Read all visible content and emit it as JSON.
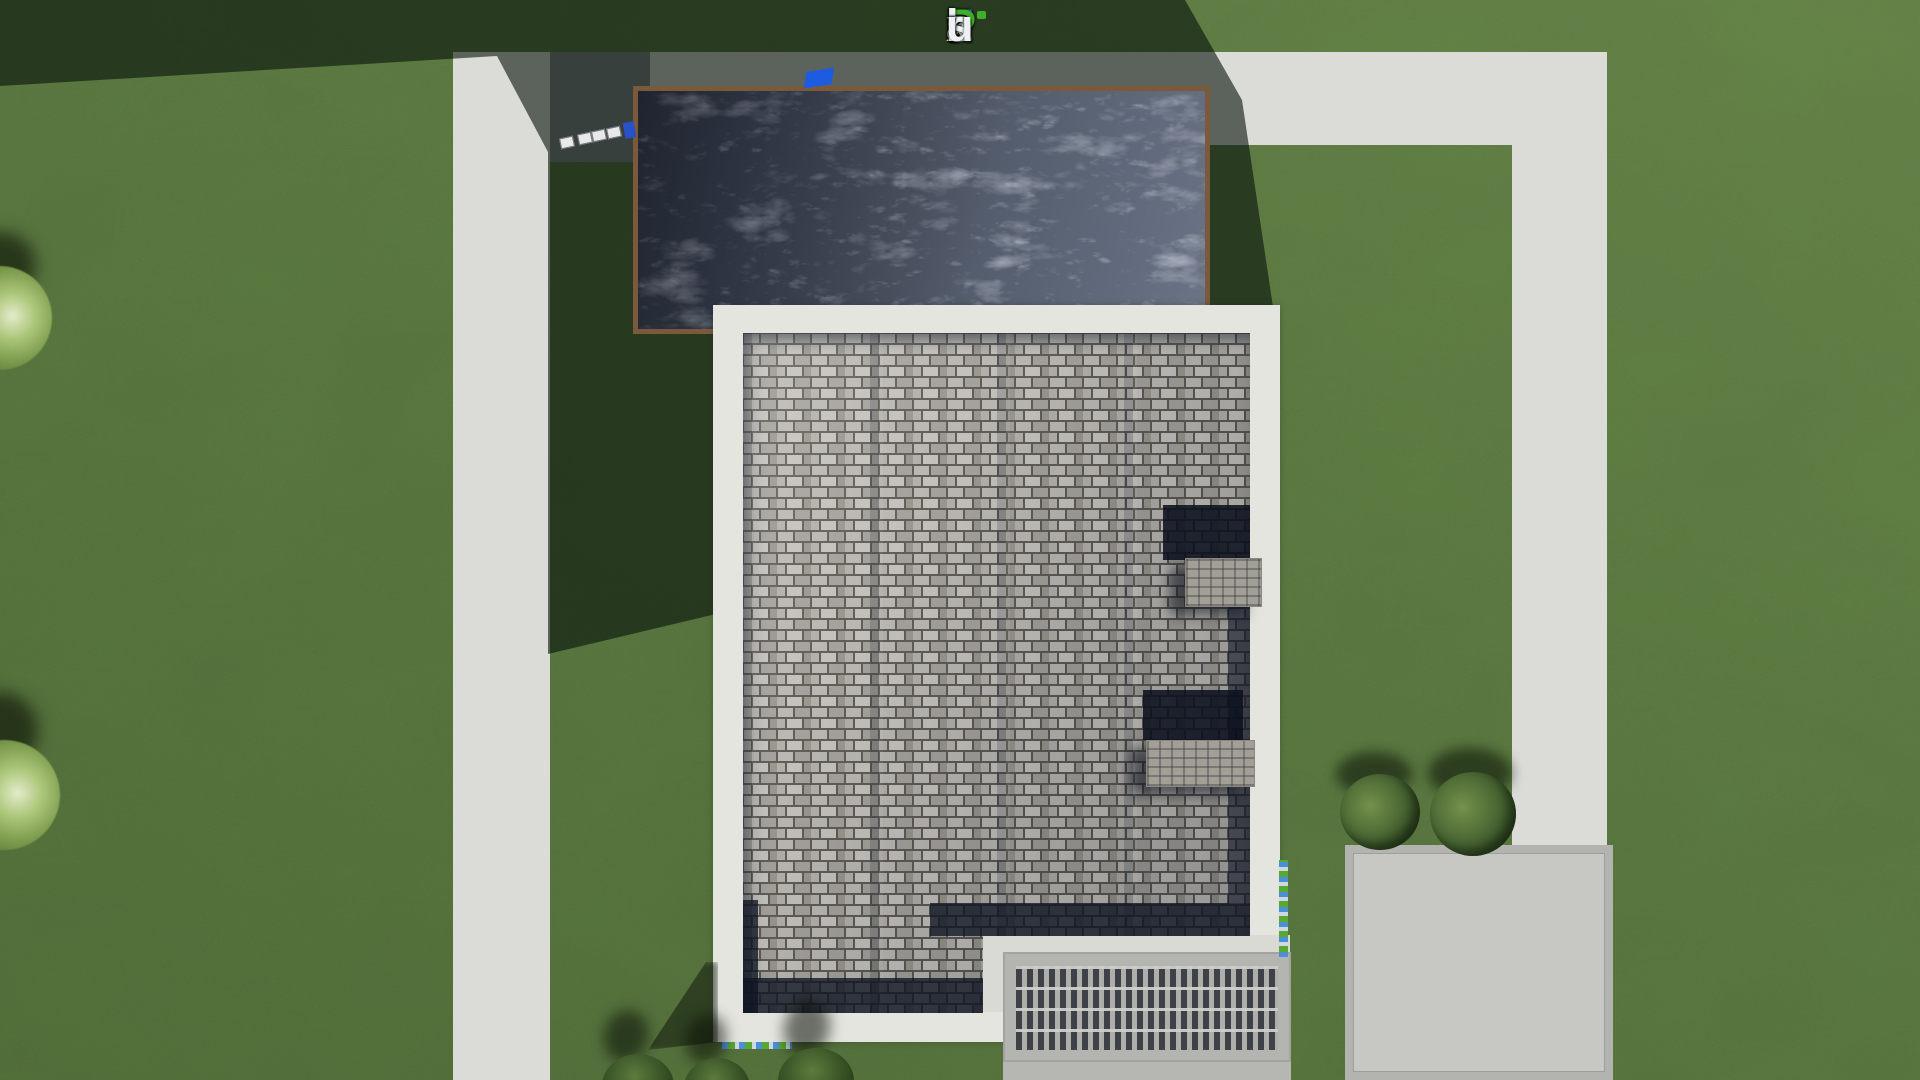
{
  "watermark": {
    "text": "FixPlans.ru",
    "letters": [
      {
        "ch": "F",
        "style": "color:#1b6ee3"
      },
      {
        "ch": "i",
        "style": "color:#eef0f4"
      },
      {
        "ch": "x",
        "style": "color:#eef0f4"
      },
      {
        "ch": "P",
        "style": "color:#3fae2a"
      },
      {
        "ch": "l",
        "style": "color:#eef0f4"
      },
      {
        "ch": "a",
        "style": "color:#eef0f4"
      },
      {
        "ch": "n",
        "style": "color:#eef0f4"
      },
      {
        "ch": "s",
        "style": "color:#eef0f4"
      },
      {
        "ch": ".",
        "style": "color:#1b6ee3"
      },
      {
        "ch": "r",
        "style": "color:#eef0f4"
      },
      {
        "ch": "u",
        "style": "color:#eef0f4"
      }
    ]
  },
  "palette": {
    "grass": "#5a7a40",
    "grass_shadow": "#243018",
    "path_light": "#dbdbd7",
    "path_shadow": "#5d6168",
    "patio": "#c7c7c3",
    "garage_roof": "#4c5464",
    "garage_border": "#7a5a3a",
    "house_parapet": "#e5e5e0",
    "roof_tile_light": "#b6b4ae",
    "roof_tile_gap": "#59564f",
    "roof_shadow_band": "#151c2a",
    "pergola_slat_dark": "#3e4147",
    "pergola_slat_light": "#aeaeaa",
    "bush_green": "#3c5728",
    "logo_blue": "#1b6ee3",
    "logo_green": "#3fae2a",
    "logo_white": "#eef0f4"
  }
}
